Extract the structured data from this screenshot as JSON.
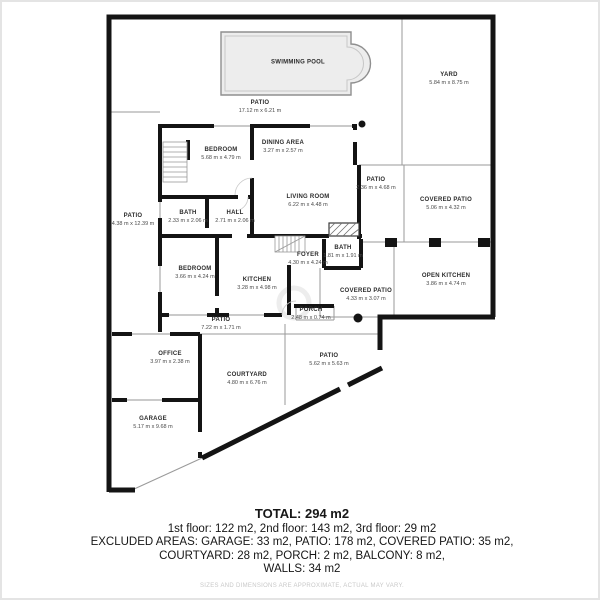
{
  "plan": {
    "wall_color": "#141414",
    "thin_line_color": "#9a9a9a",
    "window_color": "#ababab",
    "pool_fill": "#ededed",
    "pool_border": "#8f8f8f",
    "rooms": [
      {
        "name": "SWIMMING POOL",
        "dims": "",
        "x": 296,
        "y": 61
      },
      {
        "name": "YARD",
        "dims": "5.84 m x 8.75 m",
        "x": 447,
        "y": 77
      },
      {
        "name": "PATIO",
        "dims": "17.12 m x 6.21 m",
        "x": 258,
        "y": 105
      },
      {
        "name": "BEDROOM",
        "dims": "5.68 m x 4.79 m",
        "x": 219,
        "y": 152
      },
      {
        "name": "DINING AREA",
        "dims": "3.27 m x 2.57 m",
        "x": 281,
        "y": 145
      },
      {
        "name": "LIVING ROOM",
        "dims": "6.22 m x 4.48 m",
        "x": 306,
        "y": 199
      },
      {
        "name": "PATIO",
        "dims": "2.36 m x 4.68 m",
        "x": 374,
        "y": 182
      },
      {
        "name": "COVERED PATIO",
        "dims": "5.06 m x 4.32 m",
        "x": 444,
        "y": 202
      },
      {
        "name": "PATIO",
        "dims": "4.38 m x 12.39 m",
        "x": 131,
        "y": 218
      },
      {
        "name": "BATH",
        "dims": "2.33 m x 2.06 m",
        "x": 186,
        "y": 215
      },
      {
        "name": "HALL",
        "dims": "2.71 m x 2.06 m",
        "x": 233,
        "y": 215
      },
      {
        "name": "BEDROOM",
        "dims": "3.66 m x 4.24 m",
        "x": 193,
        "y": 271
      },
      {
        "name": "KITCHEN",
        "dims": "3.28 m x 4.98 m",
        "x": 255,
        "y": 282
      },
      {
        "name": "FOYER",
        "dims": "4.30 m x 4.24 m",
        "x": 306,
        "y": 257
      },
      {
        "name": "BATH",
        "dims": "1.81 m x 1.91 m",
        "x": 341,
        "y": 250
      },
      {
        "name": "OPEN KITCHEN",
        "dims": "3.86 m x 4.74 m",
        "x": 444,
        "y": 278
      },
      {
        "name": "COVERED PATIO",
        "dims": "4.33 m x 3.07 m",
        "x": 364,
        "y": 293
      },
      {
        "name": "PORCH",
        "dims": "2.48 m x 0.74 m",
        "x": 309,
        "y": 312
      },
      {
        "name": "PATIO",
        "dims": "7.22 m x 1.71 m",
        "x": 219,
        "y": 322
      },
      {
        "name": "OFFICE",
        "dims": "3.97 m x 2.38 m",
        "x": 168,
        "y": 356
      },
      {
        "name": "COURTYARD",
        "dims": "4.80 m x 6.76 m",
        "x": 245,
        "y": 377
      },
      {
        "name": "PATIO",
        "dims": "5.62 m x 5.63 m",
        "x": 327,
        "y": 358
      },
      {
        "name": "GARAGE",
        "dims": "5.17 m x 9.68 m",
        "x": 151,
        "y": 421
      }
    ]
  },
  "summary": {
    "total": "TOTAL: 294 m2",
    "floors": "1st floor: 122 m2, 2nd floor: 143 m2, 3rd floor: 29 m2",
    "excluded1": "EXCLUDED AREAS: GARAGE: 33 m2, PATIO: 178 m2, COVERED PATIO: 35 m2,",
    "excluded2": "COURTYARD: 28 m2, PORCH: 2 m2, BALCONY: 8 m2,",
    "walls": "WALLS: 34 m2",
    "disclaimer": "SIZES AND DIMENSIONS ARE APPROXIMATE, ACTUAL MAY VARY."
  }
}
